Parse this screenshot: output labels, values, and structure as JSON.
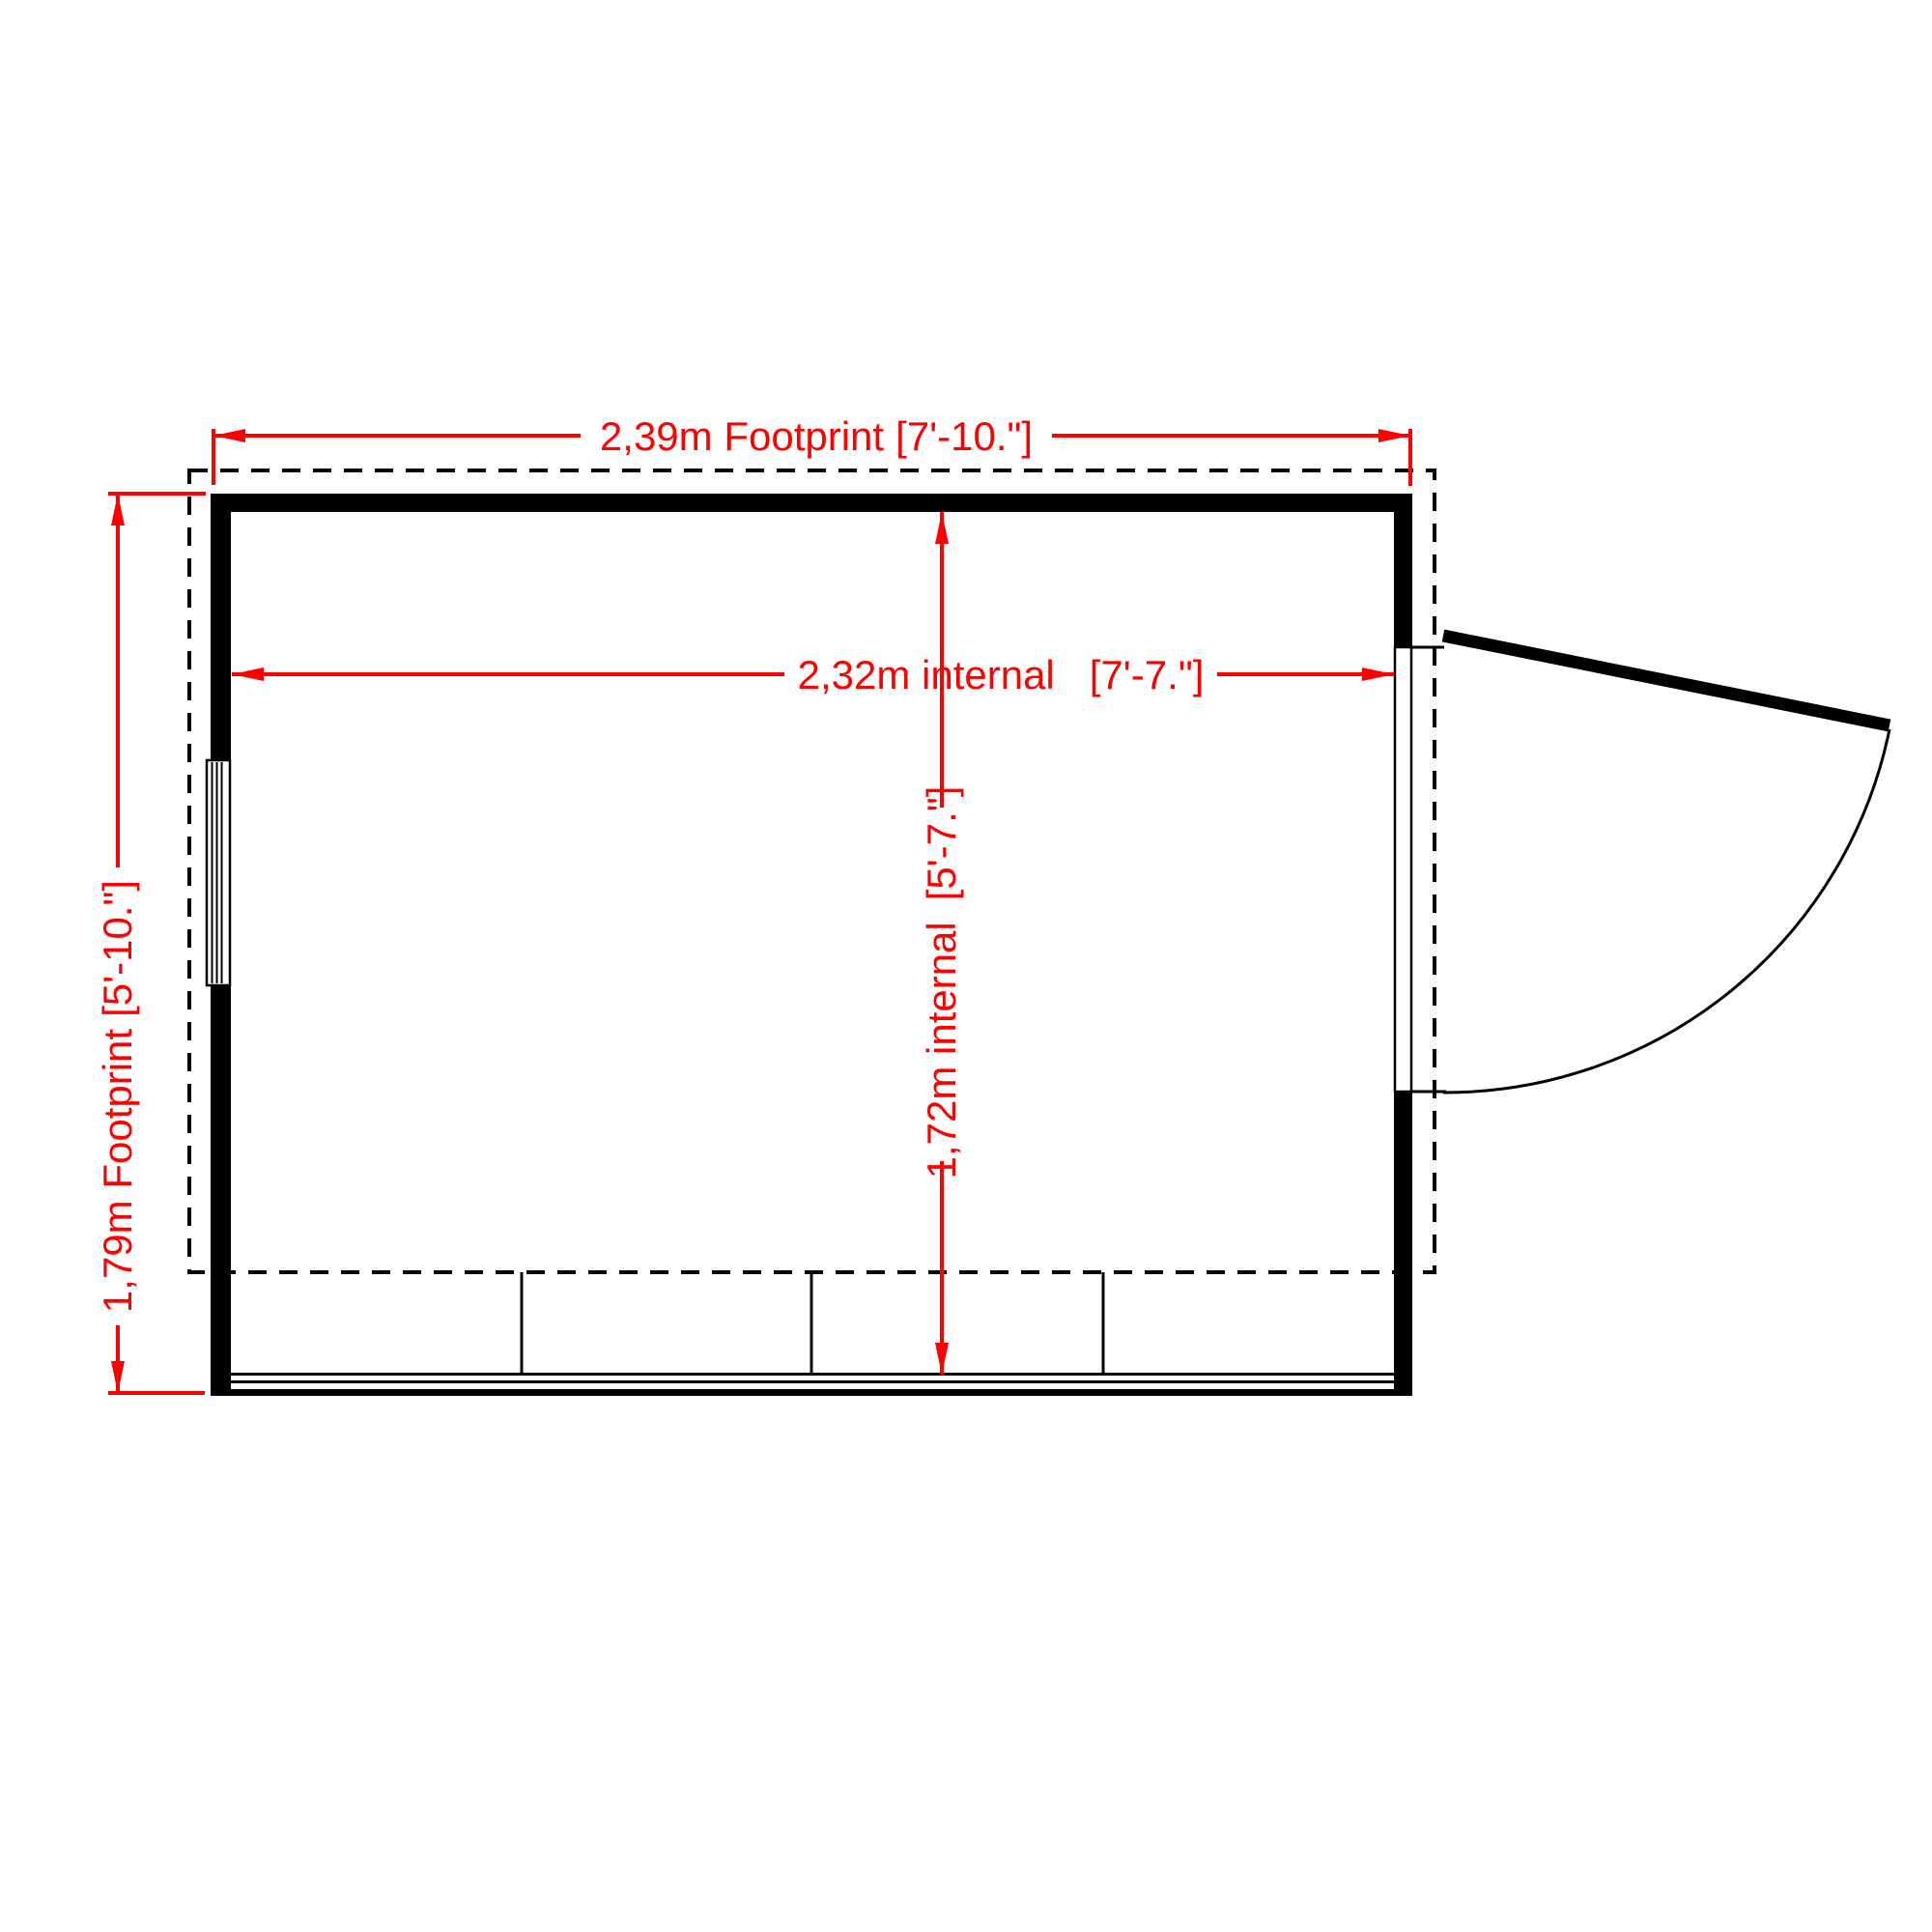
{
  "drawing": {
    "type": "shed floor plan",
    "background_color": "#FFFFFF",
    "dimension_color": "#FF0000",
    "line_color": "#000000"
  },
  "dimensions": {
    "footprint_width": {
      "metric": "2,39m Footprint",
      "imperial": "[7'-10.\"]"
    },
    "internal_width": {
      "metric": "2,32m internal",
      "imperial": "[7'-7.\"]"
    },
    "internal_depth": {
      "metric": "1,72m internal",
      "imperial": "[5'-7.\"]"
    },
    "footprint_depth": {
      "metric": "1,79m Footprint",
      "imperial": "[5'-10.\"]"
    }
  }
}
